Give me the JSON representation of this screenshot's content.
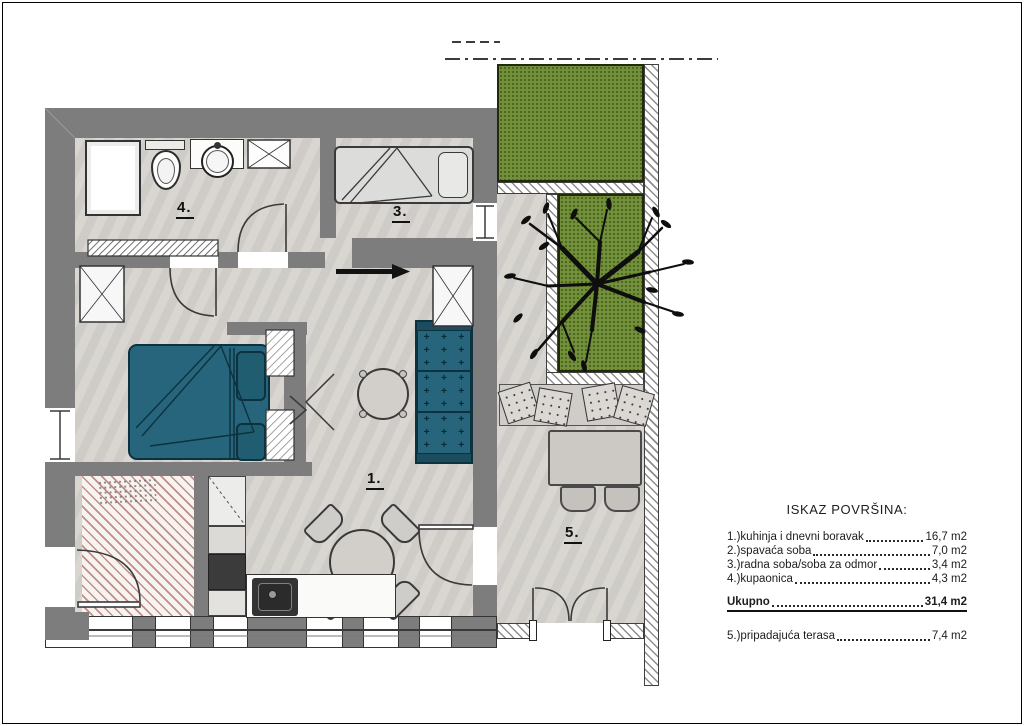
{
  "legend": {
    "title": "ISKAZ POVRŠINA:",
    "rows": [
      {
        "label": "1.)kuhinja i dnevni boravak ",
        "value": "16,7 m2",
        "style": "normal"
      },
      {
        "label": "2.)spavaća soba",
        "value": "7,0 m2",
        "style": "normal"
      },
      {
        "label": "3.)radna soba/soba za odmor",
        "value": "3,4 m2",
        "style": "normal"
      },
      {
        "label": "4.)kupaonica",
        "value": "4,3 m2",
        "style": "normal"
      },
      {
        "label": "Ukupno",
        "value": "31,4 m2",
        "style": "total"
      },
      {
        "label": "5.)pripadajuća terasa",
        "value": "7,4 m2",
        "style": "separate"
      }
    ]
  },
  "plan": {
    "labels": [
      {
        "text": "4."
      },
      {
        "text": "3."
      },
      {
        "text": "1."
      },
      {
        "text": "5."
      }
    ]
  },
  "colors": {
    "wall": "#7d7d7d",
    "floor": "#d6d3cf",
    "teal": "#26657b",
    "grass": "#72903a"
  }
}
